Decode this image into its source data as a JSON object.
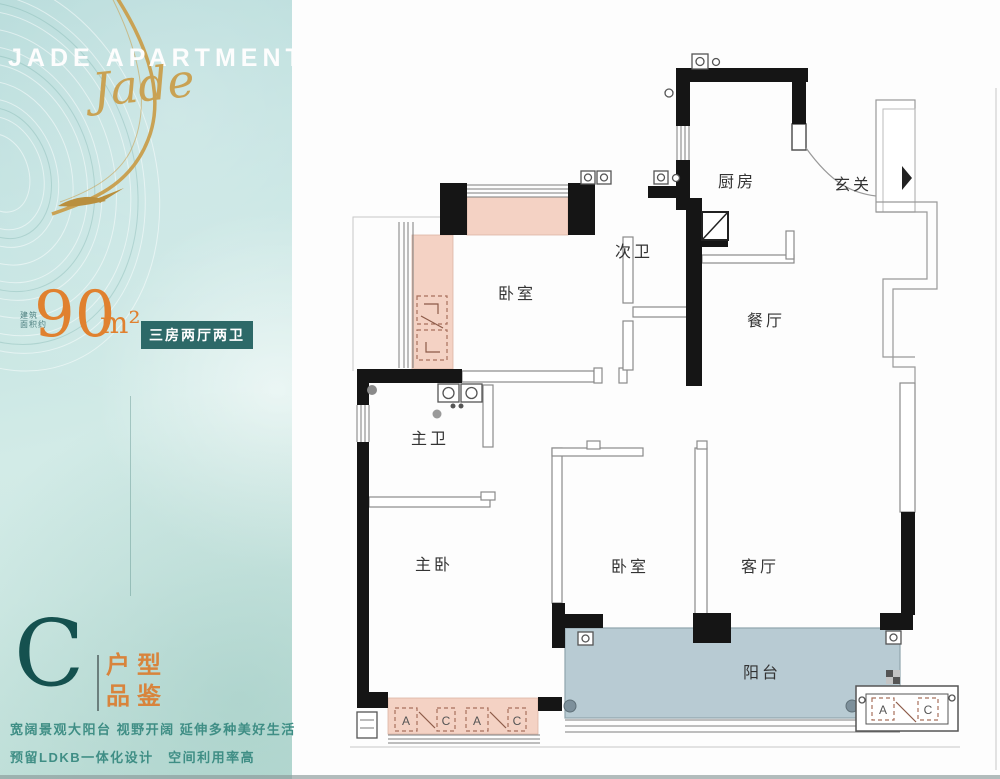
{
  "brand": {
    "title": "JADE APARTMENTS",
    "script": "Jade"
  },
  "area": {
    "prefix_line1": "建筑",
    "prefix_line2": "面积约",
    "value": "90",
    "unit": "m²",
    "badge": "三房两厅两卫"
  },
  "unit_label": {
    "letter": "C",
    "tag_line1": "户型",
    "tag_line2": "品鉴"
  },
  "taglines": {
    "line1": "宽阔景观大阳台 视野开阔 延伸多种美好生活",
    "line2": "预留LDKB一体化设计　空间利用率高"
  },
  "floorplan": {
    "rooms": [
      {
        "id": "kitchen",
        "label": "厨房"
      },
      {
        "id": "foyer",
        "label": "玄关"
      },
      {
        "id": "bath2",
        "label": "次卫"
      },
      {
        "id": "bedroom1",
        "label": "卧室"
      },
      {
        "id": "dining",
        "label": "餐厅"
      },
      {
        "id": "bath1",
        "label": "主卫"
      },
      {
        "id": "master",
        "label": "主卧"
      },
      {
        "id": "bedroom2",
        "label": "卧室"
      },
      {
        "id": "living",
        "label": "客厅"
      },
      {
        "id": "balcony",
        "label": "阳台"
      }
    ],
    "ac_marks": {
      "a": "A",
      "c": "C"
    },
    "colors": {
      "wall": "#151515",
      "wardrobe": "#f4d2c4",
      "balcony": "#b8cbd3"
    }
  },
  "colors": {
    "sidebar_teal": "#c3e3e1",
    "accent_orange": "#e0812f",
    "badge_teal": "#2d6968",
    "gold": "#c9a254",
    "tagline_teal": "#3f8e85"
  }
}
